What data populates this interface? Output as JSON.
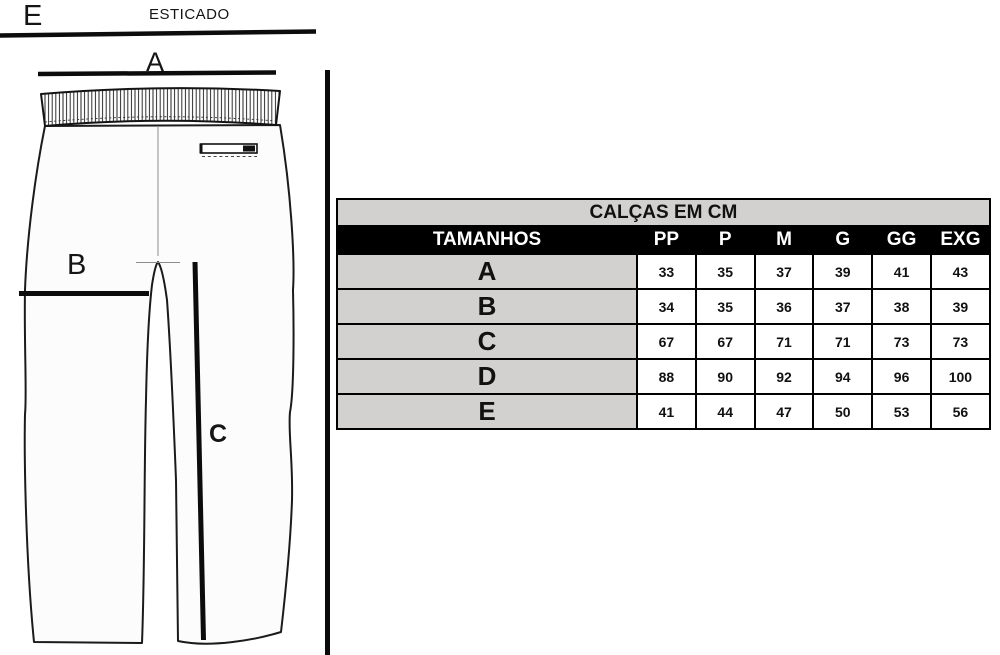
{
  "drawing": {
    "stretch_letter": "E",
    "stretch_caption": "ESTICADO",
    "label_a": "A",
    "label_b": "B",
    "label_c": "C"
  },
  "table": {
    "title": "CALÇAS EM CM",
    "corner_header": "TAMANHOS",
    "size_headers": [
      "PP",
      "P",
      "M",
      "G",
      "GG",
      "EXG"
    ],
    "rows": [
      {
        "label": "A",
        "values": [
          "33",
          "35",
          "37",
          "39",
          "41",
          "43"
        ]
      },
      {
        "label": "B",
        "values": [
          "34",
          "35",
          "36",
          "37",
          "38",
          "39"
        ]
      },
      {
        "label": "C",
        "values": [
          "67",
          "67",
          "71",
          "71",
          "73",
          "73"
        ]
      },
      {
        "label": "D",
        "values": [
          "88",
          "90",
          "92",
          "94",
          "96",
          "100"
        ]
      },
      {
        "label": "E",
        "values": [
          "41",
          "44",
          "47",
          "50",
          "53",
          "56"
        ]
      }
    ],
    "colors": {
      "header_bg": "#000000",
      "header_text": "#ffffff",
      "shade_bg": "#d2d1cf",
      "border": "#000000"
    }
  }
}
